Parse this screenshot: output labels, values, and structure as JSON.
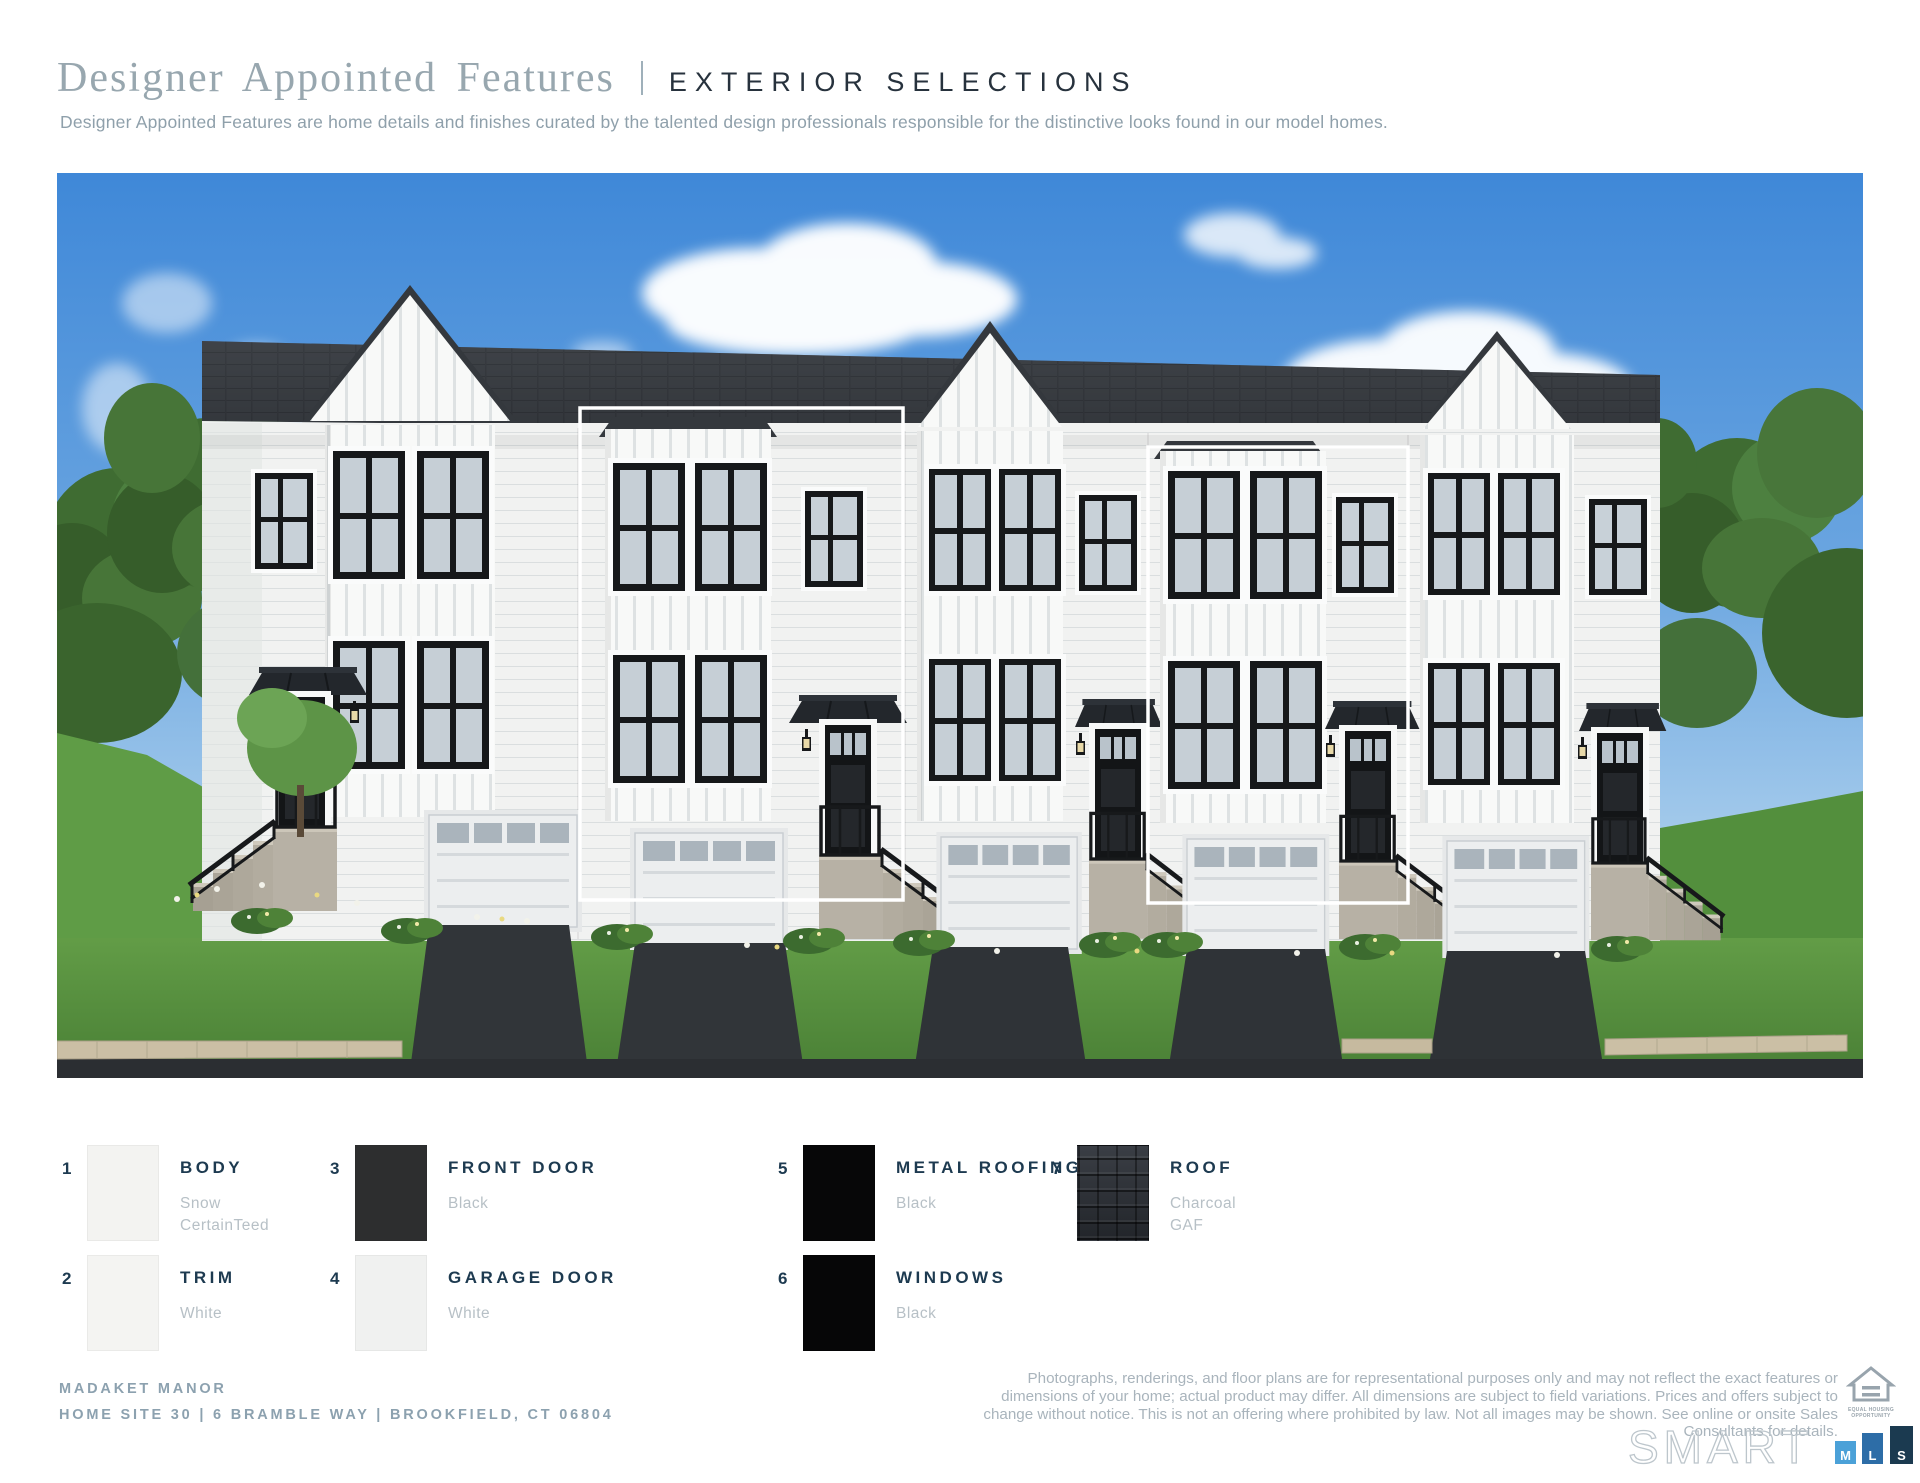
{
  "header": {
    "title": "Designer Appointed Features",
    "section": "EXTERIOR SELECTIONS",
    "subtitle": "Designer Appointed Features are home details and finishes curated by the talented design professionals responsible for the distinctive looks found in our model homes."
  },
  "legend": {
    "items": [
      {
        "num": "1",
        "label": "BODY",
        "sub1": "Snow",
        "sub2": "CertainTeed",
        "swatch": "#f3f3f1"
      },
      {
        "num": "2",
        "label": "TRIM",
        "sub1": "White",
        "sub2": "",
        "swatch": "#f4f4f2"
      },
      {
        "num": "3",
        "label": "FRONT DOOR",
        "sub1": "Black",
        "sub2": "",
        "swatch": "#2d2e2f"
      },
      {
        "num": "4",
        "label": "GARAGE DOOR",
        "sub1": "White",
        "sub2": "",
        "swatch": "#f0f1f0"
      },
      {
        "num": "5",
        "label": "METAL ROOFING",
        "sub1": "Black",
        "sub2": "",
        "swatch": "#070708"
      },
      {
        "num": "6",
        "label": "WINDOWS",
        "sub1": "Black",
        "sub2": "",
        "swatch": "#060607"
      },
      {
        "num": "7",
        "label": "ROOF",
        "sub1": "Charcoal",
        "sub2": "GAF",
        "swatch": "#2b2e33"
      }
    ]
  },
  "footer": {
    "community": "MADAKET MANOR",
    "address": "HOME SITE 30  |  6 BRAMBLE WAY  |  BROOKFIELD, CT 06804",
    "disclaimer": "Photographs, renderings, and floor plans are for representational purposes only and may not reflect the exact features or dimensions of your home; actual product may differ. All dimensions are subject to field variations. Prices and offers subject to change without notice. This is not an offering where prohibited by law. Not all images may be shown. See online or onsite Sales Consultants for details.",
    "equal_housing_line1": "EQUAL HOUSING",
    "equal_housing_line2": "OPPORTUNITY",
    "smart_logo": {
      "word": "SMART",
      "bar1": "M",
      "bar2": "L",
      "bar3": "S"
    }
  },
  "colors": {
    "accent_navy": "#1d3a50",
    "title_gray": "#98a7af",
    "label_sub_gray": "#b7c0c6",
    "sky_blue": "#3f88d8",
    "mls_bar_light": "#4ba1d8",
    "mls_bar_mid": "#2d6da7",
    "mls_bar_dark": "#1b3a50"
  }
}
